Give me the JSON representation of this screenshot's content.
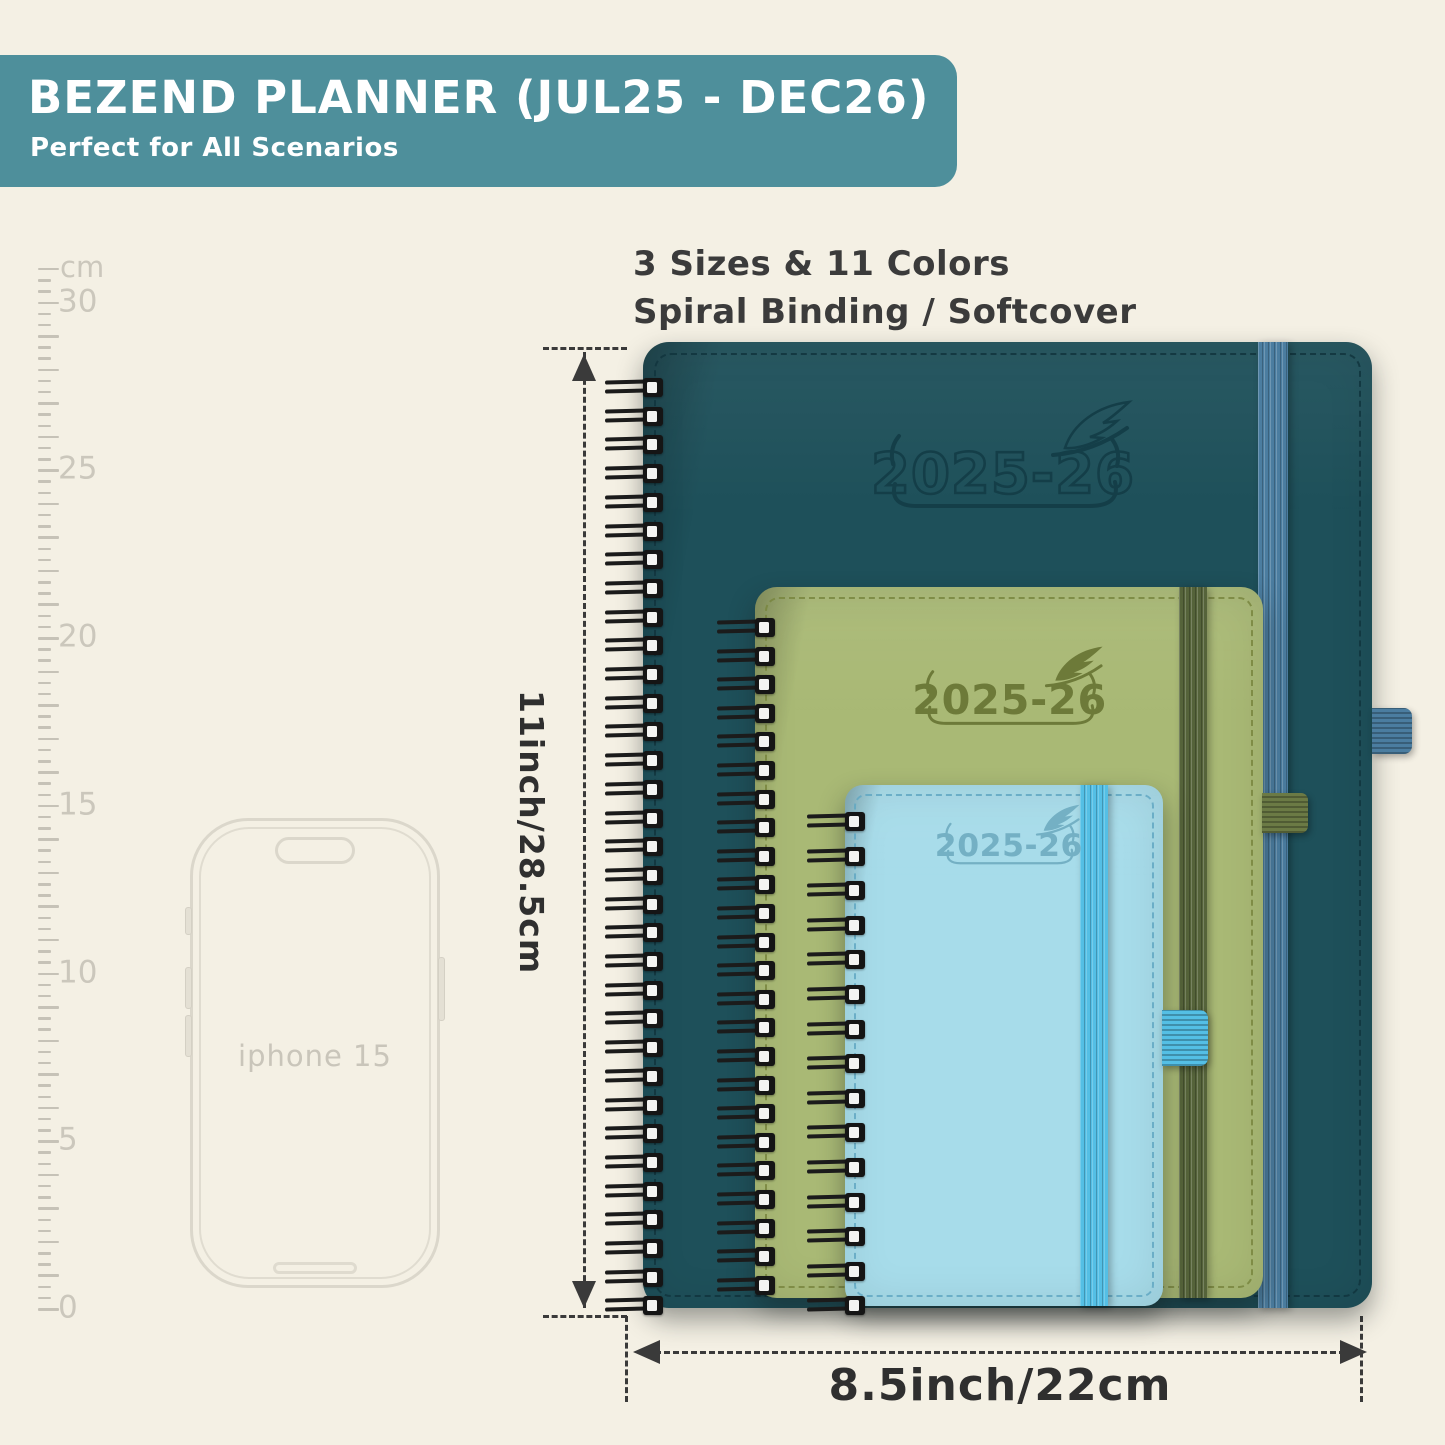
{
  "page": {
    "bg_color": "#f4f0e4"
  },
  "banner": {
    "title": "BEZEND PLANNER (JUL25 - DEC26)",
    "subtitle": "Perfect for All Scenarios",
    "bg_color": "#4e8f9b",
    "text_color": "#ffffff"
  },
  "features": {
    "line1": "3 Sizes & 11 Colors",
    "line2": "Spiral Binding / Softcover"
  },
  "ruler": {
    "unit_label": "cm",
    "marks": [
      {
        "label": "30",
        "cm": 30
      },
      {
        "label": "25",
        "cm": 25
      },
      {
        "label": "20",
        "cm": 20
      },
      {
        "label": "15",
        "cm": 15
      },
      {
        "label": "10",
        "cm": 10
      },
      {
        "label": "5",
        "cm": 5
      },
      {
        "label": "0",
        "cm": 0
      }
    ]
  },
  "phone": {
    "label": "iphone 15"
  },
  "planners": [
    {
      "name": "large",
      "year": "2025-26",
      "cover_color": "#1e505a",
      "emboss_color": "#143e48",
      "band_color": "#4b7da0",
      "loop_color": "#4b7da0",
      "stitch_color": "#11353e",
      "year_style": "outline"
    },
    {
      "name": "medium",
      "year": "2025-26",
      "cover_color": "#a9b975",
      "emboss_color": "#6d7a39",
      "band_color": "#55633a",
      "loop_color": "#6b7a45",
      "stitch_color": "#79863f",
      "year_style": "solid"
    },
    {
      "name": "small",
      "year": "2025-26",
      "cover_color": "#a7dcea",
      "emboss_color": "#74b0c4",
      "band_color": "#54bfe5",
      "loop_color": "#54bfe5",
      "stitch_color": "#62a8c3",
      "year_style": "solid"
    }
  ],
  "dimensions": {
    "height_label": "11inch/28.5cm",
    "width_label": "8.5inch/22cm",
    "line_color": "#3a3a3a"
  }
}
